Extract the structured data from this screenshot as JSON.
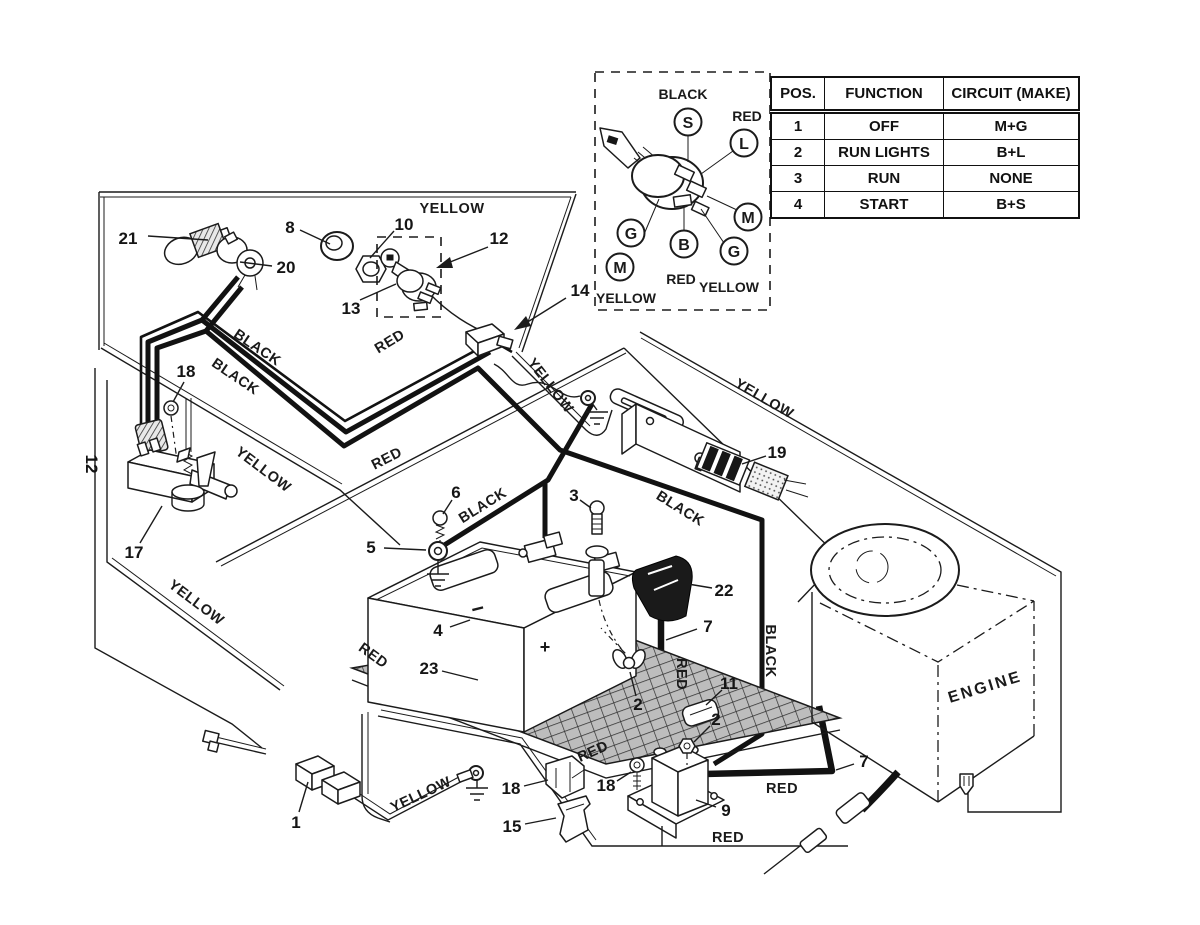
{
  "table": {
    "headers": [
      "POS.",
      "FUNCTION",
      "CIRCUIT (MAKE)"
    ],
    "rows": [
      [
        "1",
        "OFF",
        "M+G"
      ],
      [
        "2",
        "RUN LIGHTS",
        "B+L"
      ],
      [
        "3",
        "RUN",
        "NONE"
      ],
      [
        "4",
        "START",
        "B+S"
      ]
    ]
  },
  "ignition_inset": {
    "terminals": {
      "s": "S",
      "l": "L",
      "m_right": "M",
      "g_right": "G",
      "b": "B",
      "g_left": "G",
      "m_left": "M"
    },
    "labels": {
      "black": "BLACK",
      "red_top": "RED",
      "red_bottom": "RED",
      "yellow_right": "YELLOW",
      "yellow_left": "YELLOW"
    }
  },
  "engine": {
    "label": "ENGINE"
  },
  "battery": {
    "negative_sign": "−",
    "positive_sign": "+"
  },
  "callouts": {
    "c1": "1",
    "c2a": "2",
    "c2b": "2",
    "c3": "3",
    "c4": "4",
    "c5": "5",
    "c6": "6",
    "c7a": "7",
    "c7b": "7",
    "c8": "8",
    "c9": "9",
    "c10": "10",
    "c11": "11",
    "c12a": "12",
    "c12b": "12",
    "c13": "13",
    "c14": "14",
    "c15": "15",
    "c17": "17",
    "c18a": "18",
    "c18b": "18",
    "c18c": "18",
    "c19": "19",
    "c20": "20",
    "c21": "21",
    "c22": "22",
    "c23": "23"
  },
  "wire_labels": {
    "y1": "YELLOW",
    "y2": "YELLOW",
    "y3": "YELLOW",
    "y4": "YELLOW",
    "y5": "YELLOW",
    "y6": "YELLOW",
    "b1": "BLACK",
    "b2": "BLACK",
    "b3": "BLACK",
    "b4": "BLACK",
    "b5": "BLACK",
    "r1": "RED",
    "r2": "RED",
    "r3": "RED",
    "r4": "RED",
    "r5": "RED",
    "r6": "RED",
    "r7": "RED"
  }
}
